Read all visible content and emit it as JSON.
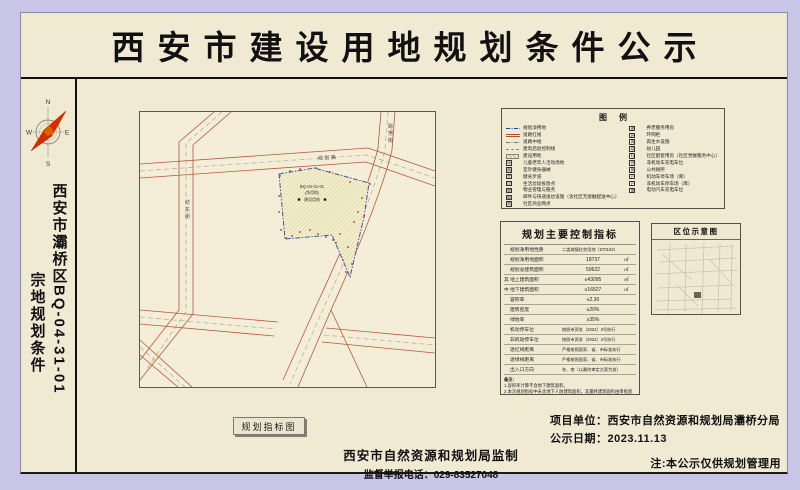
{
  "title": "西安市建设用地规划条件公示",
  "colors": {
    "background": "#c9c5e6",
    "paper": "#f0ead3",
    "road_red": "#b5593a",
    "parcel_blue": "#44579f",
    "marker_red": "#c22a10"
  },
  "sidebar": {
    "vertical_title_col1": "西安市灞桥区BQ-04-31-01",
    "vertical_title_col2": "宗地规划条件",
    "compass": {
      "n": "N",
      "e": "E",
      "s": "S",
      "w": "W"
    }
  },
  "map": {
    "caption": "规划指标图",
    "roads": [
      {
        "name": "规划路"
      },
      {
        "name": "跨塄街"
      },
      {
        "name": "纺东街"
      }
    ],
    "parcel_label": [
      "BQ-04-31-01",
      "(净用地)",
      "建设用地"
    ]
  },
  "legend": {
    "title": "图例",
    "left_items": [
      {
        "label": "规划净用地",
        "sym": "blue-dashdot-line",
        "icon": "net-land-line"
      },
      {
        "label": "道路红线",
        "sym": "red-double-line",
        "icon": "road-redline"
      },
      {
        "label": "道路中线",
        "sym": "gray-dashdot-line",
        "icon": "road-centerline"
      },
      {
        "label": "建筑后退控制线",
        "sym": "gray-dash-line",
        "icon": "setback-line"
      },
      {
        "label": "建设用地",
        "sym": "hatch-swatch",
        "icon": "construction-land"
      },
      {
        "label": "儿童老年人活动场地",
        "sym": "icon-box",
        "glyph": "场",
        "icon": "activity-ground"
      },
      {
        "label": "室外健身器械",
        "sym": "icon-box",
        "glyph": "器",
        "icon": "fitness-equipment"
      },
      {
        "label": "健身步道",
        "sym": "icon-box",
        "glyph": "步",
        "icon": "fitness-trail"
      },
      {
        "label": "生活垃圾投放点",
        "sym": "icon-box",
        "glyph": "垃",
        "icon": "garbage-point"
      },
      {
        "label": "物业管理与服务",
        "sym": "icon-box",
        "glyph": "物",
        "icon": "property-service"
      },
      {
        "label": "邮件与快递送达设施（含社区无接触配送中心）",
        "sym": "icon-box",
        "glyph": "邮",
        "icon": "mail-delivery"
      },
      {
        "label": "社区商业网点",
        "sym": "icon-box",
        "glyph": "商",
        "icon": "community-business"
      }
    ],
    "right_items": [
      {
        "label": "养老服务用房",
        "sym": "icon-box",
        "glyph": "老",
        "icon": "elderly-service"
      },
      {
        "label": "环网柜",
        "sym": "icon-box",
        "glyph": "环",
        "icon": "ring-main-unit"
      },
      {
        "label": "再生水设施",
        "sym": "icon-box",
        "glyph": "再",
        "icon": "reclaimed-water"
      },
      {
        "label": "幼儿园",
        "sym": "icon-box",
        "glyph": "幼",
        "icon": "kindergarten"
      },
      {
        "label": "社区配套用房（社区党群服务中心）",
        "sym": "icon-box",
        "glyph": "社",
        "icon": "community-room"
      },
      {
        "label": "非机动车充电车位",
        "sym": "icon-box",
        "glyph": "充",
        "icon": "nonmotor-charging"
      },
      {
        "label": "公共厕所",
        "sym": "icon-box",
        "glyph": "厕",
        "icon": "public-toilet"
      },
      {
        "label": "机动车停车场（库）",
        "sym": "icon-box",
        "glyph": "P",
        "icon": "motor-parking"
      },
      {
        "label": "非机动车停车场（库）",
        "sym": "icon-box",
        "glyph": "P",
        "icon": "nonmotor-parking"
      },
      {
        "label": "电动汽车充电车位",
        "sym": "icon-box",
        "glyph": "电",
        "icon": "ev-charging"
      }
    ]
  },
  "indicators": {
    "title": "规划主要控制指标",
    "rows": [
      {
        "group": "",
        "label": "规划净用地性质",
        "value": "二类城镇住宅用地（070102）",
        "unit": ""
      },
      {
        "group": "",
        "label": "规划净用地面积",
        "value": "18737",
        "unit": "㎡"
      },
      {
        "group": "",
        "label": "规划总建筑面积",
        "value": "59622",
        "unit": "㎡"
      },
      {
        "group": "其",
        "label": "地上建筑面积",
        "value": "≤43095",
        "unit": "㎡"
      },
      {
        "group": "中",
        "label": "地下建筑面积",
        "value": "≥16527",
        "unit": "㎡"
      },
      {
        "group": "",
        "label": "容积率",
        "value": "≤2.30",
        "unit": ""
      },
      {
        "group": "",
        "label": "建筑密度",
        "value": "≤20%",
        "unit": ""
      },
      {
        "group": "",
        "label": "绿地率",
        "value": "≥35%",
        "unit": ""
      },
      {
        "group": "",
        "label": "机动停车位",
        "value": "按照市资发〔2022〕3号执行",
        "unit": ""
      },
      {
        "group": "",
        "label": "非机动停车位",
        "value": "按照市资发〔2022〕3号执行",
        "unit": ""
      },
      {
        "group": "",
        "label": "退红线距离",
        "value": "严格按照国家、省、市标准执行",
        "unit": ""
      },
      {
        "group": "",
        "label": "退绿线距离",
        "value": "严格按照国家、省、市标准执行",
        "unit": ""
      },
      {
        "group": "",
        "label": "出入口方向",
        "value": "东、南（以最终审定方案为准）",
        "unit": ""
      }
    ],
    "notes_title": "备注:",
    "notes": [
      "1.容积率计算不含地下建筑面积。",
      "2.本次规划指标中未含地下人防建筑面积，其最终建筑面积由审批部门审核确定。",
      "3.规划净用地面积以实测为准。",
      "4.机动车及非机动车停车位按照《西安市建设项目停车位配建标准》（市资发〔2022〕3号）配置，最终以审批部门审批意见为准。"
    ]
  },
  "location_map": {
    "title": "区位示意图"
  },
  "footer": {
    "project_unit": "项目单位：西安市自然资源和规划局灞桥分局",
    "publish_date": "公示日期：2023.11.13",
    "note": "注:本公示仅供规划管理用",
    "supervisor": "西安市自然资源和规划局监制",
    "hotline": "监督举报电话：029-83527048"
  }
}
